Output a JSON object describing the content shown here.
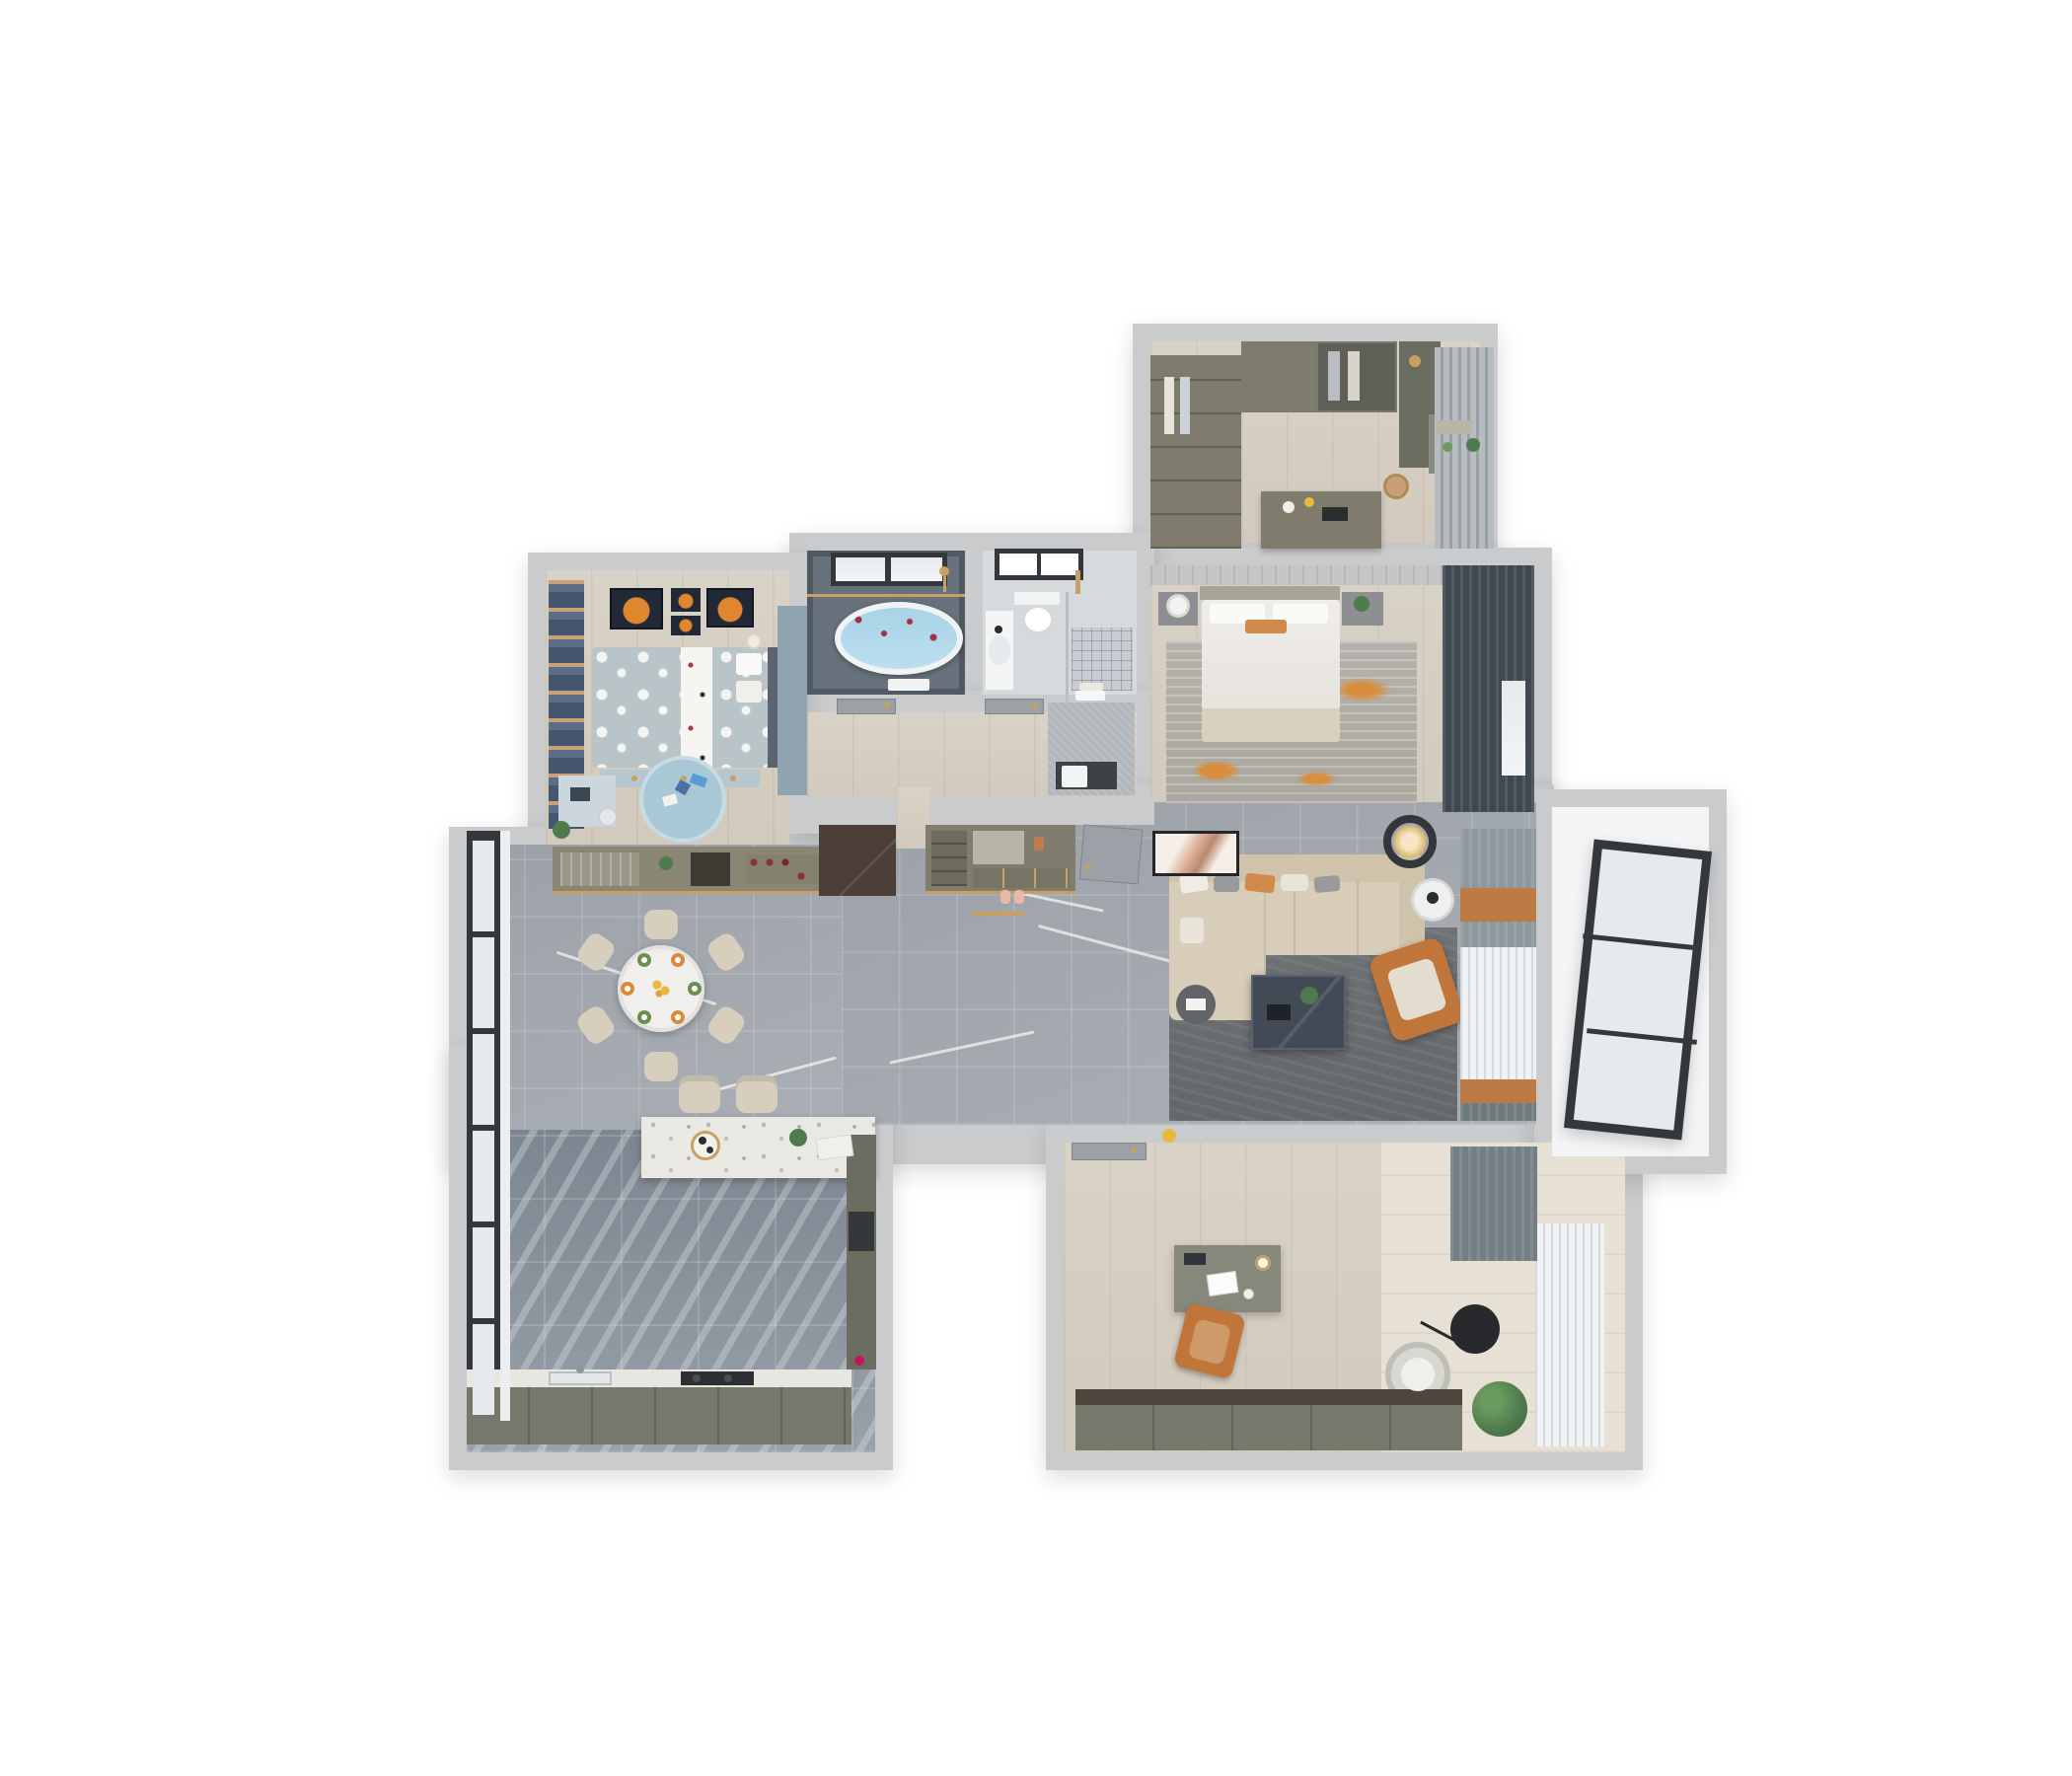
{
  "scene": {
    "kind": "3d-floor-plan-render",
    "view": "top-down dollhouse cutaway",
    "background": "#ffffff",
    "rooms": [
      {
        "id": "walk-in-closet-study",
        "floor": "light-wood",
        "furniture": [
          "wardrobe-left",
          "wardrobe-top",
          "glass-wardrobe",
          "shelf-unit",
          "vanity-dresser-with-mirror",
          "rattan-basket",
          "desk-island",
          "window-blinds"
        ]
      },
      {
        "id": "master-bedroom",
        "floor": "light-wood",
        "furniture": [
          "double-bed",
          "white-pillows",
          "orange-accent-pillow",
          "beige-throw",
          "nightstand-left-with-lamp",
          "nightstand-right-with-plant",
          "distressed-gray-orange-rug",
          "dark-curtains",
          "window"
        ]
      },
      {
        "id": "bathroom-dark",
        "floor": "slate-tile",
        "furniture": [
          "oval-bathtub-with-rose-petals",
          "black-frame-window",
          "gold-shower-rail",
          "shower-head",
          "towel"
        ]
      },
      {
        "id": "bathroom-light",
        "floor": "light-tile",
        "furniture": [
          "wall-hung-toilet",
          "window",
          "sink-counter",
          "glass-partition",
          "gold-shower-set",
          "shower-floor-drain",
          "towels"
        ]
      },
      {
        "id": "hallway",
        "floor": "light-wood",
        "furniture": [
          "bathroom-door-1",
          "bathroom-door-2",
          "laundry-cabinet-with-washer"
        ]
      },
      {
        "id": "kids-bedroom",
        "floor": "light-wood",
        "furniture": [
          "navy-curtains",
          "planet-artwork-frames",
          "polka-dot-bed",
          "white-runner",
          "teddy-bear",
          "bedside-drawer-bench",
          "blue-wardrobe",
          "study-desk",
          "desk-chair",
          "round-blue-play-rug",
          "plant"
        ]
      },
      {
        "id": "dining-room",
        "floor": "gray-marble",
        "furniture": [
          "wine-display-cabinet",
          "dark-marble-accent-panel",
          "round-dining-table",
          "dining-chairs-x6",
          "place-settings",
          "flower-centerpiece",
          "floor-to-ceiling-windows"
        ]
      },
      {
        "id": "entrance-foyer",
        "floor": "gray-marble",
        "furniture": [
          "shoe-cabinet-with-mirror-niche",
          "gold-threshold",
          "slippers",
          "entrance-door"
        ]
      },
      {
        "id": "living-room",
        "floor": "gray-marble",
        "furniture": [
          "l-shaped-beige-sofa",
          "throw-pillows",
          "round-side-table",
          "chaise-side-table",
          "dark-marble-coffee-table",
          "orange-leather-armchair",
          "gray-area-rug",
          "ring-ceiling-light",
          "leaning-artwork",
          "curtain-wall-gray-orange-sheer",
          "yellow-kettle"
        ]
      },
      {
        "id": "kitchen",
        "floor": "dark-marble-tile",
        "furniture": [
          "terrazzo-island-bar",
          "bar-stools-x2",
          "serving-tray",
          "counter-run-with-sink-and-cooktop",
          "tall-cabinet-with-oven",
          "black-frame-windows",
          "red-flower"
        ]
      },
      {
        "id": "office-study",
        "floor": "light-wood-planks",
        "furniture": [
          "door",
          "desk-with-laptop-and-lamp",
          "tan-desk-chair",
          "black-disc-side-table",
          "arc-floor-lamp",
          "round-lounge-chair",
          "potted-plant",
          "sheer-curtains",
          "dark-curtain-panel",
          "low-cabinet-run"
        ]
      },
      {
        "id": "balcony",
        "floor": "white-tile",
        "furniture": [
          "leaning-window-panel-3-pane"
        ]
      }
    ]
  },
  "palette": {
    "wall": "#c9cbcd",
    "wood": "#d9d2c6",
    "woodDeep": "#d2cabd",
    "officeWoodLight": "#e7e0d4",
    "marble": "#9ba1a7",
    "marbleDeep": "#aab0b6",
    "tileDark": "#7d8690",
    "tileDark2": "#98a0a9",
    "slateFloor": "#67727c",
    "slateWall": "#4f5a63",
    "water": "#a8d3e6",
    "petals": "#a23045",
    "bathLight": "#d6dadd",
    "showerTile": "#c6ccd2",
    "olive": "#7f7c6d",
    "oliveDark": "#6b6d60",
    "oliveCab": "#75786b",
    "counterWhite": "#e8e6e0",
    "terrazzo": "#eae8e2",
    "navy": "#46566e",
    "tan": "#c7a078",
    "kidsBlue": "#b8c4c8",
    "kidsRug": "#a9c8d6",
    "kidsCab": "#b7c6cf",
    "artNavy": "#222936",
    "planet": "#e0862e",
    "duvet": "#efedea",
    "throw": "#d9d1c0",
    "headboard": "#a8a396",
    "rugMaster": "#b4b1ab",
    "rugOrange": "#d78f3f",
    "curtainDark": "#3f4850",
    "blinds": "#b6bcc0",
    "sofa": "#d8cdb8",
    "sofaDark": "#cfc3ac",
    "pillowOrange": "#d08a4c",
    "pillowGray": "#989a9c",
    "rugLiving": "#6f7375",
    "coffee": "#424a56",
    "armOrange": "#c0763a",
    "gold": "#c9a063",
    "doorGray": "#9ba1a6",
    "laundry": "#b2b7bb",
    "white": "#f4f5f6",
    "glass": "#e6eaec",
    "frameDark": "#34383c",
    "stool": "#d7cebe",
    "sheer": "#eff1f2",
    "curtainGray": "#8d979c",
    "orangeCurtain": "#bd7a45",
    "plant": "#4e7a4e",
    "balconyFloor": "#f3f4f5",
    "shoeCab": "#807d6e",
    "marbleBrown": "#4b3f38",
    "mirror": "#b9b6a8",
    "black": "#2b2e31",
    "red": "#c2185b",
    "yellow": "#e8b93c"
  }
}
